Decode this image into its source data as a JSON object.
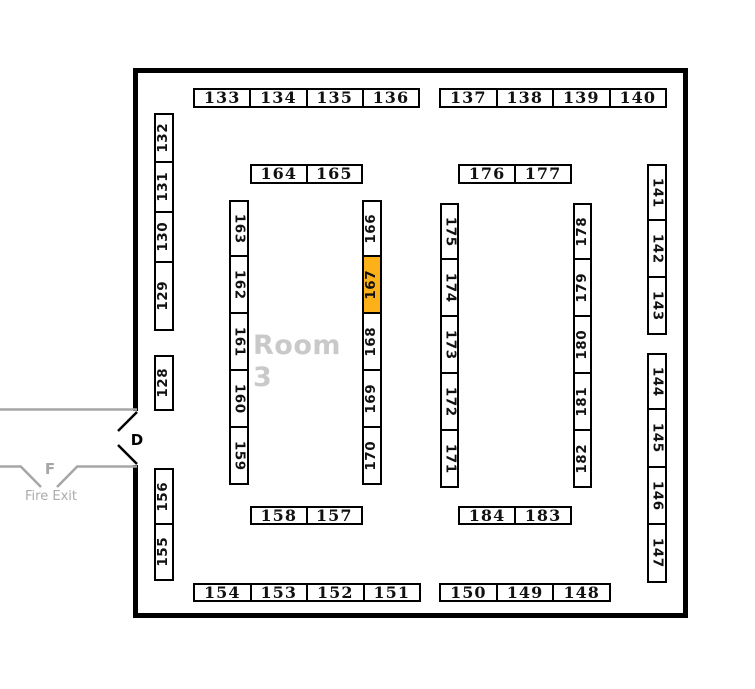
{
  "room_label": "Room 3",
  "door": {
    "label": "D"
  },
  "fire_exit": {
    "door_label": "F",
    "label": "Fire Exit"
  },
  "highlighted_booth": "167",
  "colors": {
    "highlight": "#FBB117",
    "wall": "#000000",
    "corridor_gray": "#A6A6A6",
    "room_label_gray": "#C9C9C9"
  },
  "booth_groups": {
    "top_left_row": [
      "133",
      "134",
      "135",
      "136"
    ],
    "top_right_row": [
      "137",
      "138",
      "139",
      "140"
    ],
    "inner_pair_top_left": [
      "164",
      "165"
    ],
    "inner_pair_top_right": [
      "176",
      "177"
    ],
    "left_wall_upper": [
      "132",
      "131",
      "130",
      "129"
    ],
    "left_wall_mid": [
      "128"
    ],
    "left_wall_lower": [
      "156",
      "155"
    ],
    "right_wall_upper": [
      "141",
      "142",
      "143"
    ],
    "right_wall_lower": [
      "144",
      "145",
      "146",
      "147"
    ],
    "inner_col_left_a": [
      "163",
      "162",
      "161",
      "160",
      "159"
    ],
    "inner_col_left_b": [
      "166",
      "167",
      "168",
      "169",
      "170"
    ],
    "inner_col_right_a": [
      "175",
      "174",
      "173",
      "172",
      "171"
    ],
    "inner_col_right_b": [
      "178",
      "179",
      "180",
      "181",
      "182"
    ],
    "inner_pair_bottom_left": [
      "158",
      "157"
    ],
    "inner_pair_bottom_right": [
      "184",
      "183"
    ],
    "bottom_left_row": [
      "154",
      "153",
      "152",
      "151"
    ],
    "bottom_right_row": [
      "150",
      "149",
      "148"
    ]
  }
}
